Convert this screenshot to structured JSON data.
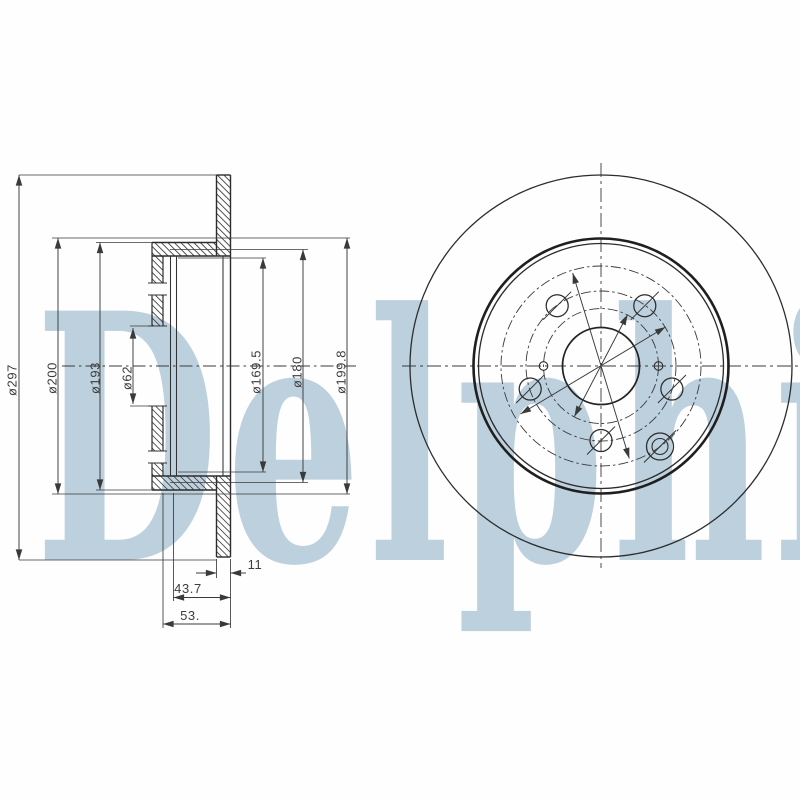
{
  "document": {
    "type": "technical-drawing",
    "subject": "brake-disc"
  },
  "watermark": {
    "text": "Delphi",
    "color": "#bcd0de"
  },
  "section_view": {
    "left_dims": [
      "ø297",
      "ø200",
      "ø193",
      "ø62"
    ],
    "right_dims": [
      "ø169.5",
      "ø180",
      "ø199.8"
    ],
    "bottom_dims": [
      "11",
      "43.7",
      "53."
    ]
  },
  "front_view": {
    "lug_hole_count": 5,
    "small_hole_count": 2,
    "set_screw_hole_count": 1
  },
  "colors": {
    "line": "#2c2c2c",
    "dim_line": "#3a3a3a",
    "background": "#ffffff"
  }
}
